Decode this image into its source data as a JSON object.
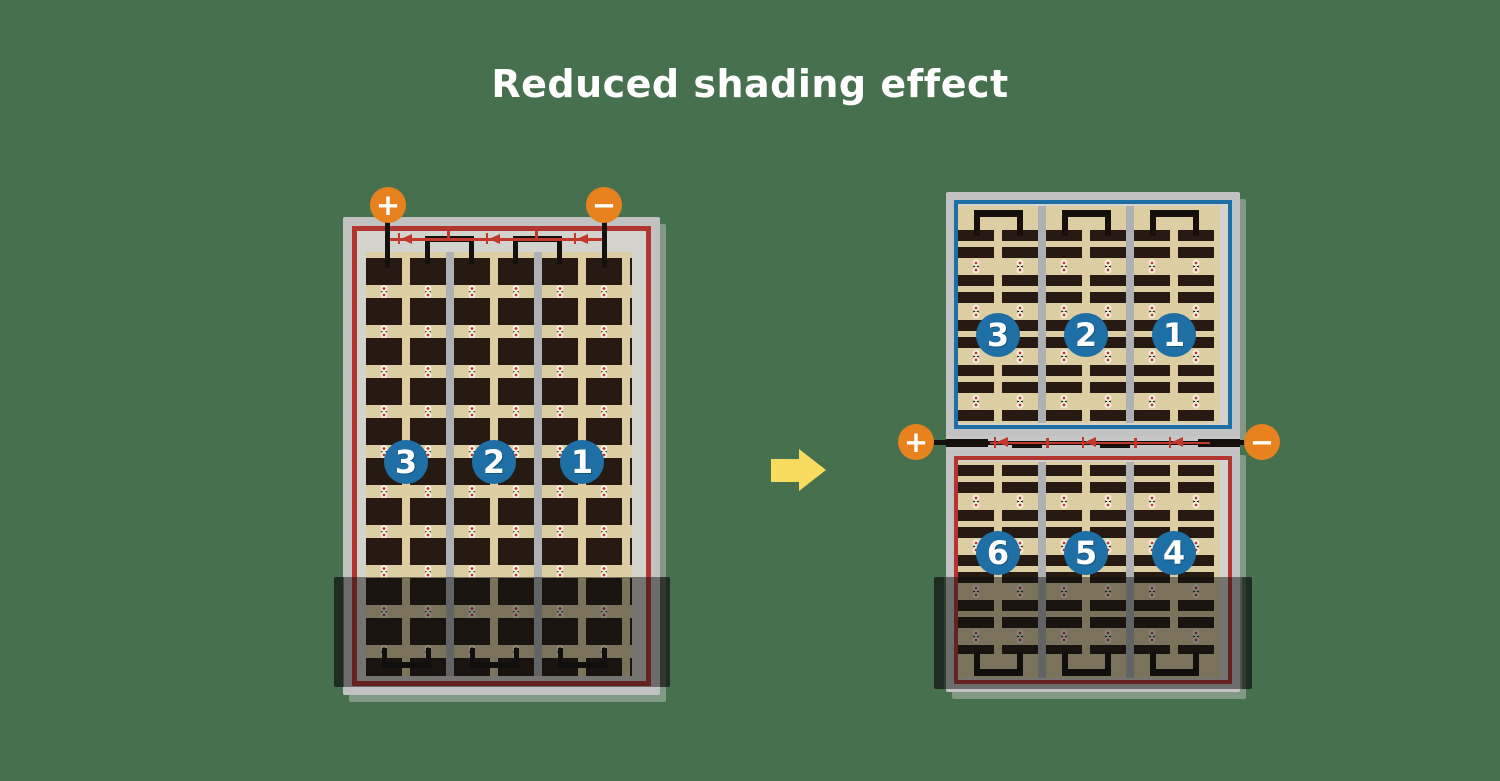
{
  "title": "Reduced shading effect",
  "left_panel": {
    "terminal_plus": "+",
    "terminal_minus": "−",
    "string_labels": [
      "3",
      "2",
      "1"
    ]
  },
  "right_panel": {
    "terminal_plus": "+",
    "terminal_minus": "−",
    "top_string_labels": [
      "3",
      "2",
      "1"
    ],
    "bottom_string_labels": [
      "6",
      "5",
      "4"
    ]
  },
  "colors": {
    "background": "#47714E",
    "title_text": "#FFFFFF",
    "panel_frame": "#C2C2C2",
    "panel_inner": "#D3D2CC",
    "cell_field": "#DCCDA2",
    "cell_dark": "#261A12",
    "string_separator": "#AEB0B4",
    "red_circuit": "#B23530",
    "blue_circuit": "#1D6FA5",
    "badge_blue": "#1D6FA5",
    "terminal_orange": "#E8821F",
    "diode_red": "#C0392B",
    "arrow_yellow": "#F8DB5F",
    "wire_black": "#15100C",
    "shade": "rgba(15,15,15,0.48)"
  }
}
